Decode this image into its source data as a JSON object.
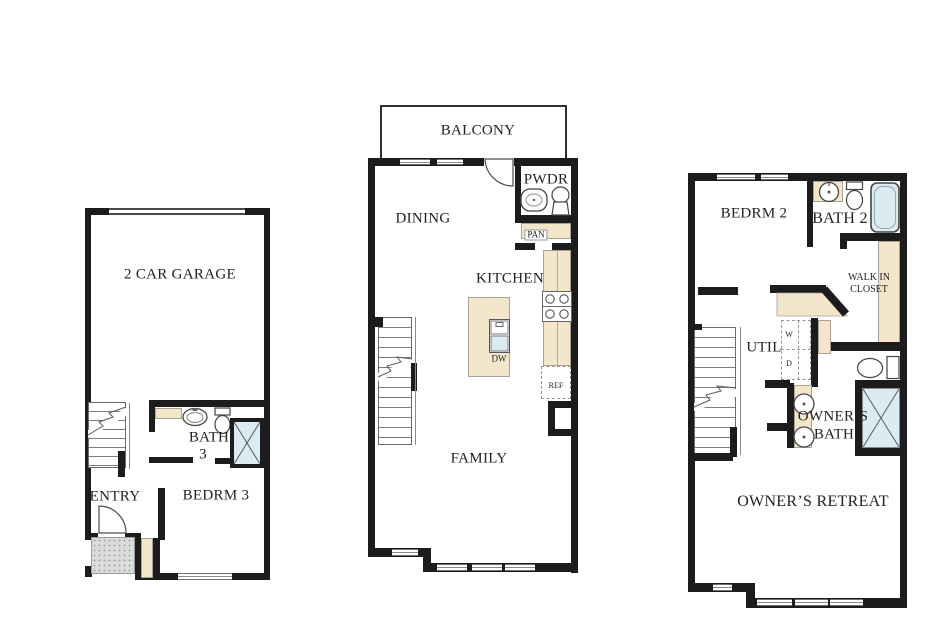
{
  "floor1": {
    "garage_label": "2 CAR GARAGE",
    "bath_label_1": "BATH",
    "bath_label_2": "3",
    "entry_label": "ENTRY",
    "bedroom_label": "BEDRM 3"
  },
  "floor2": {
    "balcony_label": "BALCONY",
    "dining_label": "DINING",
    "powder_label": "PWDR",
    "pantry_label": "PAN",
    "kitchen_label": "KITCHEN",
    "dishwasher_label": "DW",
    "refrigerator_label": "REF",
    "family_label": "FAMILY"
  },
  "floor3": {
    "bedroom_label": "BEDRM 2",
    "bath_label": "BATH 2",
    "walkin_label_1": "WALK IN",
    "walkin_label_2": "CLOSET",
    "utility_label": "UTIL",
    "washer_label": "W",
    "dryer_label": "D",
    "owners_bath_label_1": "OWNER’S",
    "owners_bath_label_2": "BATH",
    "owners_retreat_label": "OWNER’S RETREAT"
  },
  "colors": {
    "wall": "#1c1c1c",
    "counter": "#f4e6cb",
    "water": "#dcebf2",
    "porch": "#dcdcdc"
  }
}
